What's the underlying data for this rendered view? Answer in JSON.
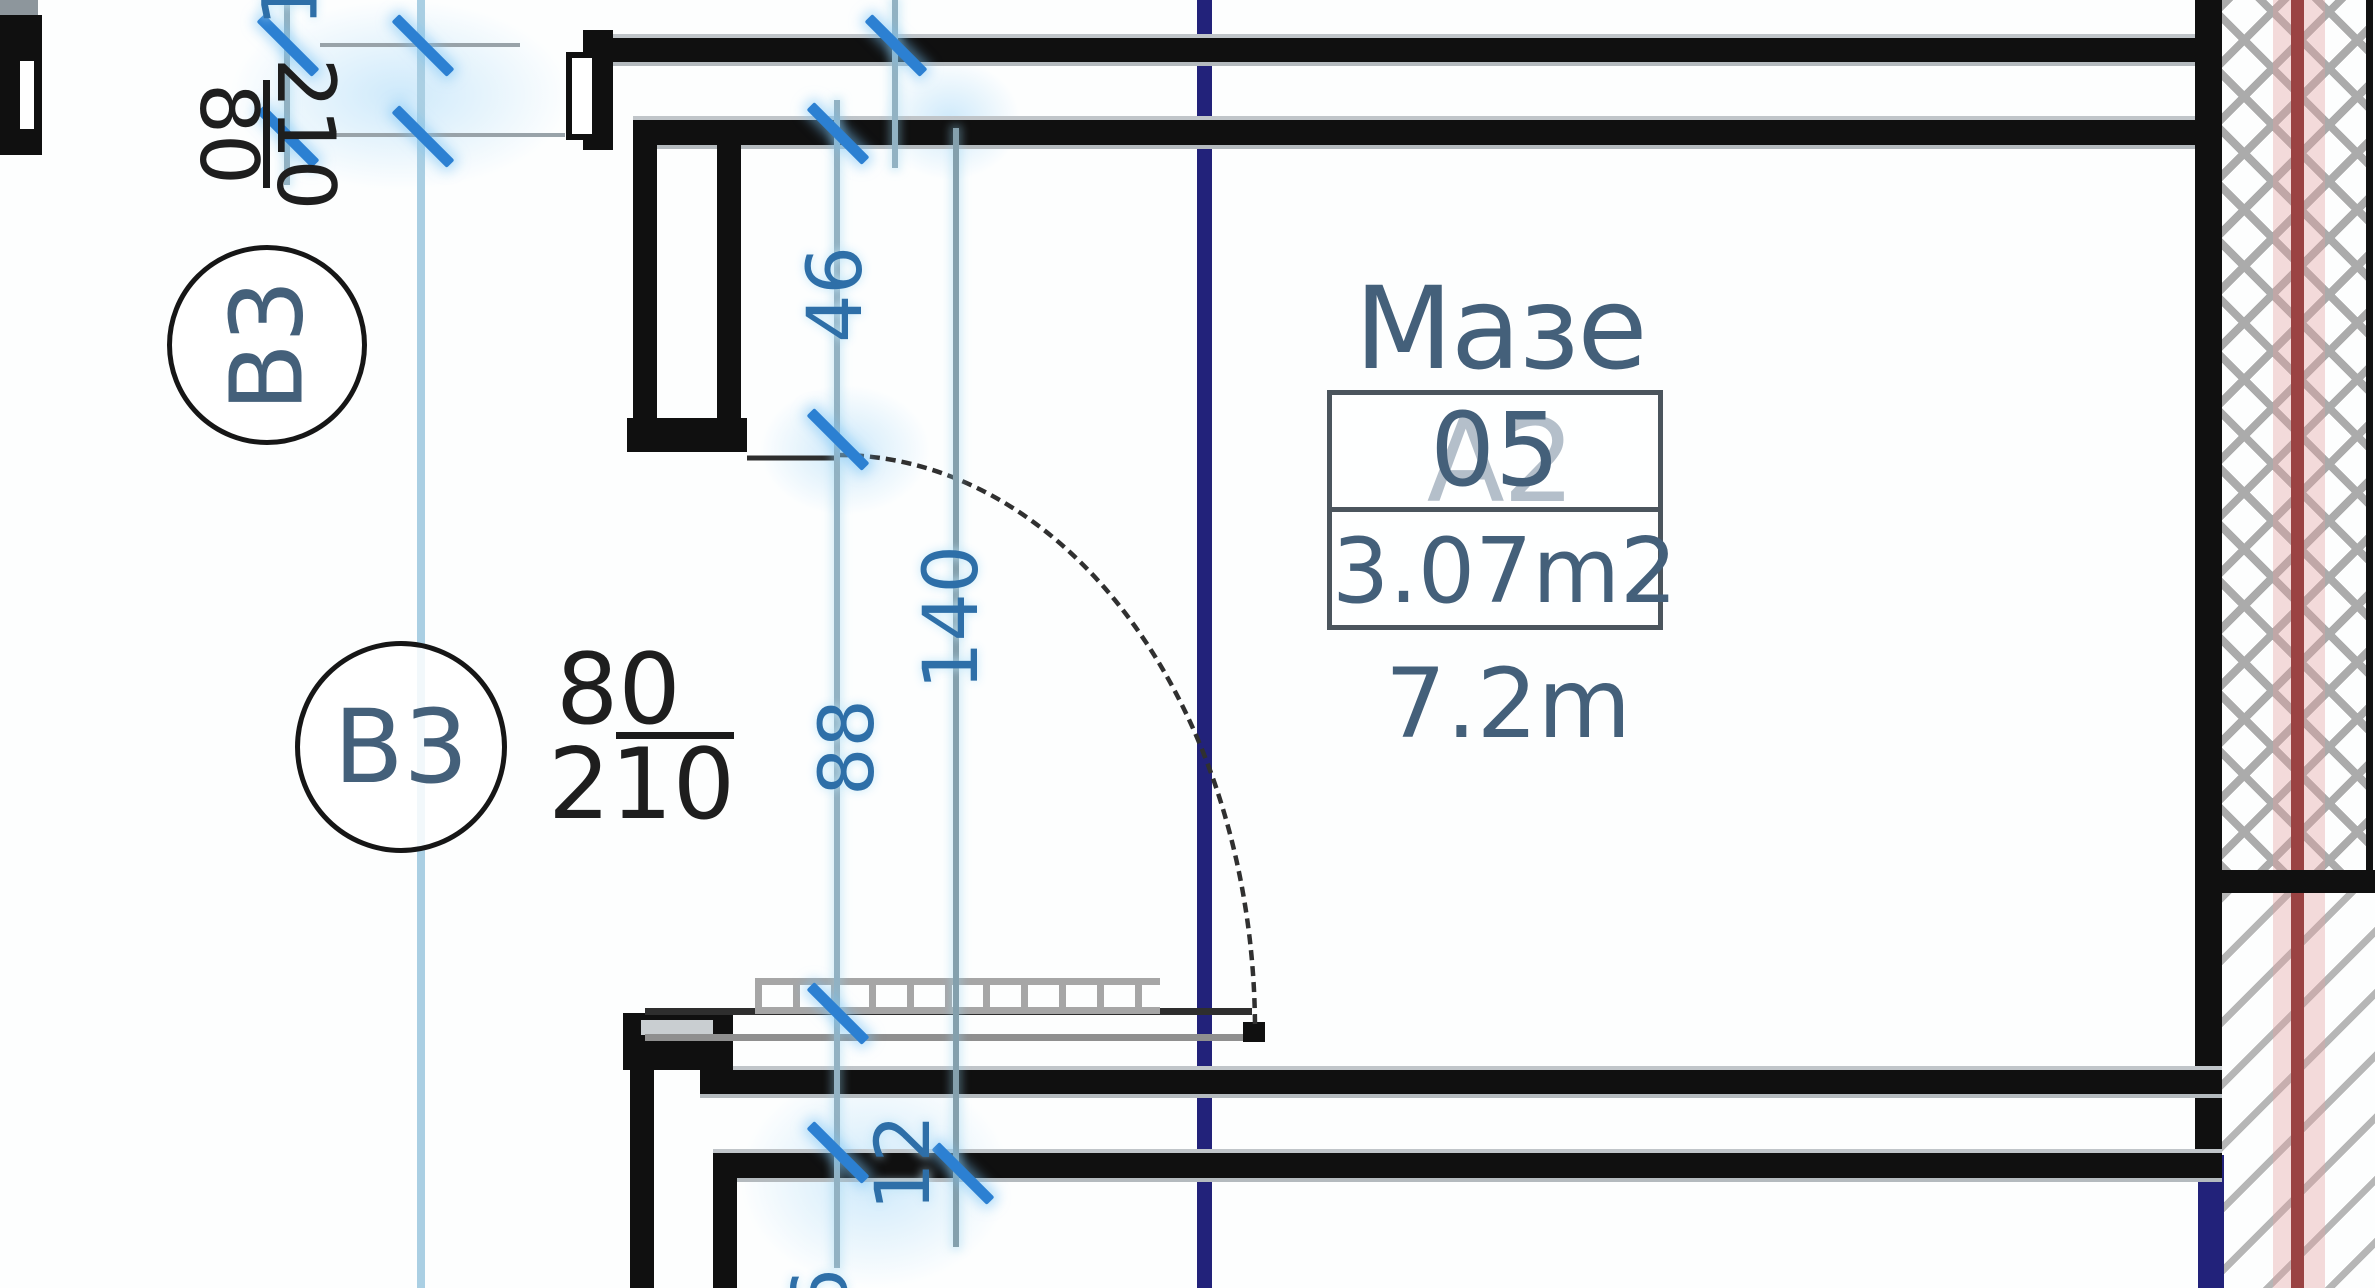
{
  "plan": {
    "room": {
      "name": "Мазе А2",
      "number": "05",
      "area": "3.07m2",
      "perimeter": "7.2m"
    },
    "door_tags": [
      {
        "code": "B3",
        "width": "80",
        "height": "210"
      },
      {
        "code": "B3",
        "width": "80",
        "height": "210"
      }
    ],
    "dims": {
      "top_cut": "1",
      "d46": "46",
      "d88": "88",
      "d140": "140",
      "d12": "12",
      "d6": "6"
    },
    "colors": {
      "wall": "#101010",
      "dim_number_blue": "#2e6fa8",
      "tick_blue": "#2c80d2",
      "axis_light_blue": "#aacfe3",
      "axis_navy": "#22227a",
      "axis_red": "#9a4343",
      "label_slate": "#44607a",
      "hatch_gray": "#ababab"
    }
  }
}
